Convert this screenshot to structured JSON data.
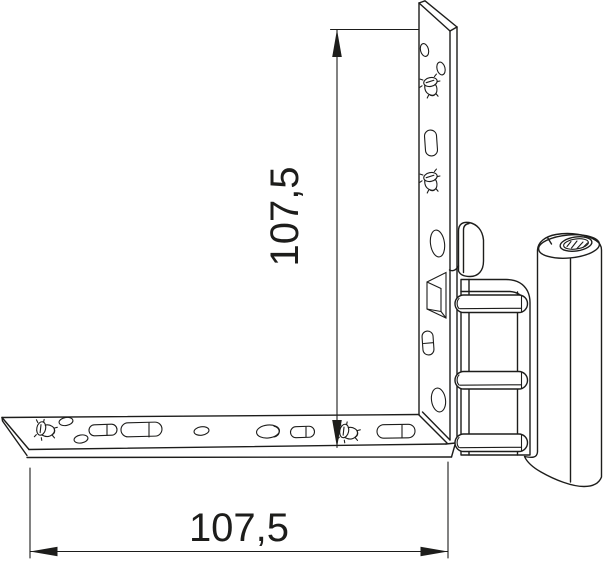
{
  "drawing": {
    "colors": {
      "line": "#1d1d1b",
      "background": "#ffffff"
    },
    "dimensions": {
      "vertical": {
        "label": "107,5"
      },
      "horizontal": {
        "label": "107,5"
      }
    },
    "parts": {
      "vertical_plate": "vertical-frame-plate",
      "horizontal_plate": "horizontal-frame-plate",
      "hinge_tab": "hinge-tab",
      "hinge_bracket": "hinge-bracket",
      "hinge_ribs": "hinge-rib",
      "hinge_barrel": "hinge-barrel",
      "screw_marker": "screw-icon"
    }
  }
}
